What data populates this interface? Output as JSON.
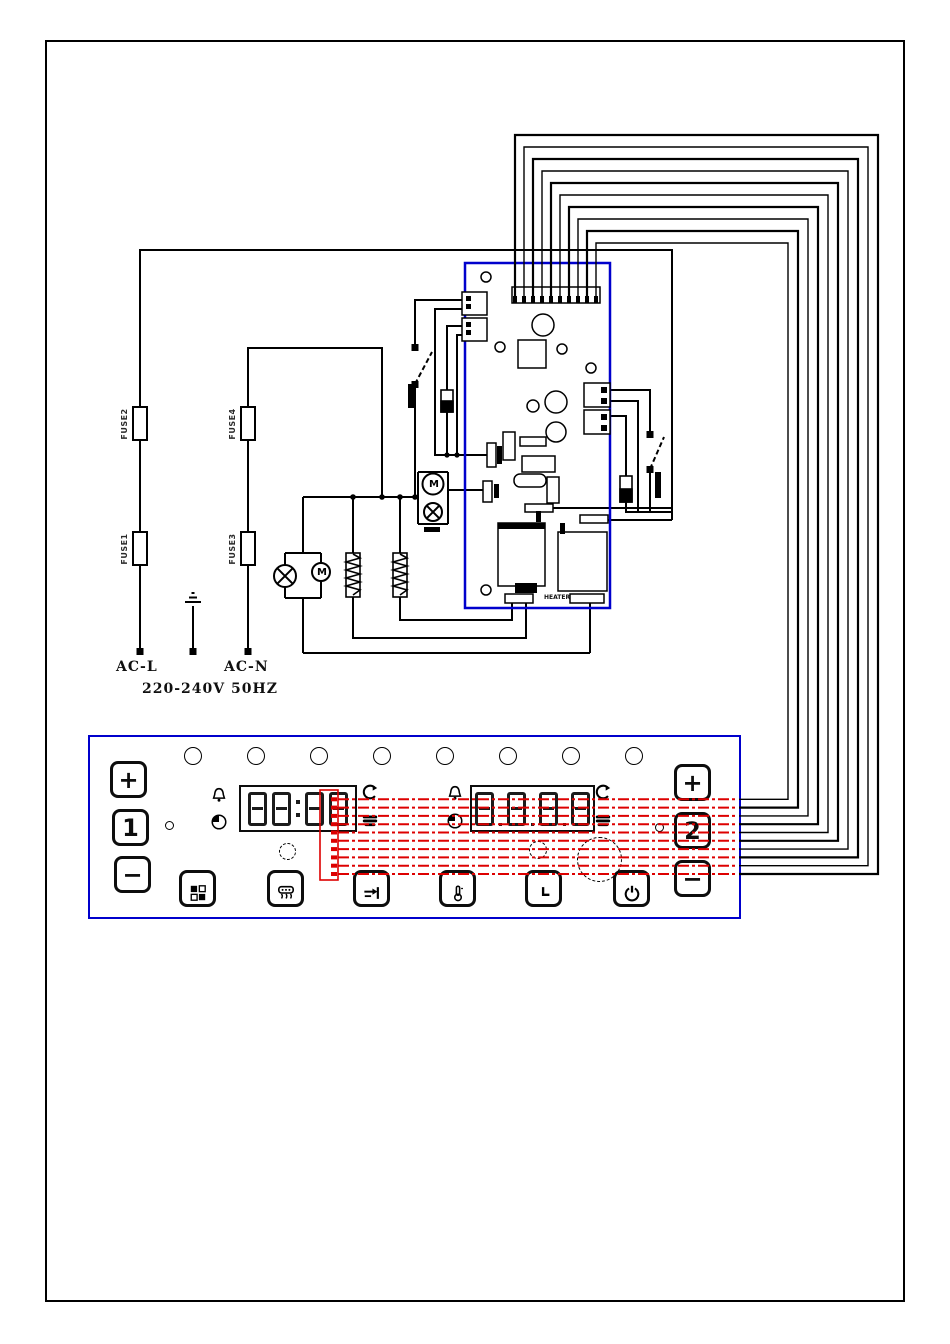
{
  "schematic": {
    "power": {
      "line": "AC-L",
      "neutral": "AC-N",
      "rating": "220-240V 50HZ"
    },
    "fuses": {
      "f1": "FUSE1",
      "f2": "FUSE2",
      "f3": "FUSE3",
      "f4": "FUSE4"
    },
    "motor_symbol": "M",
    "heater_label": "HEATER",
    "colors": {
      "board_outline": "#0000cc",
      "panel_outline": "#0000cc",
      "wire": "#000000",
      "signal_bus": "#dd0000"
    }
  },
  "panel": {
    "buttons": {
      "plus_left": "+",
      "one": "1",
      "minus_left": "−",
      "plus_right": "+",
      "two": "2",
      "minus_right": "−"
    },
    "displays": {
      "left": "88:88",
      "right": "8888"
    }
  }
}
